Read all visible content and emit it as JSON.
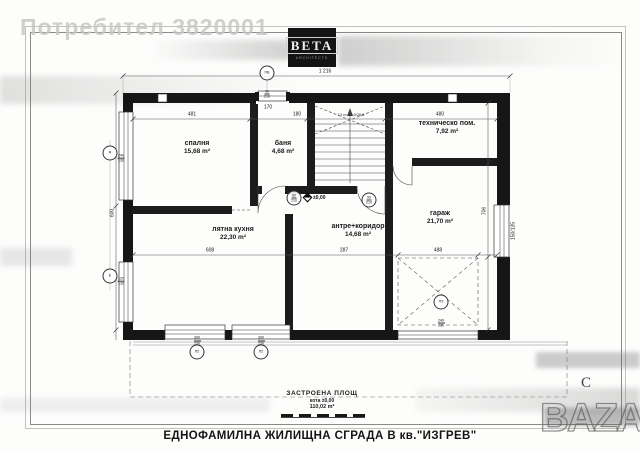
{
  "watermarks": {
    "user": "Потребител 3820001",
    "bazar": "BAZAR"
  },
  "logo": {
    "name": "BETA",
    "sub": "ARCHITECTS"
  },
  "north": "С",
  "plan": {
    "rooms": [
      {
        "name": "спалня",
        "area": "15,68 m²",
        "x": 197,
        "y": 148
      },
      {
        "name": "баня",
        "area": "4,68 m²",
        "x": 283,
        "y": 148
      },
      {
        "name": "техническо пом.",
        "area": "7,92 m²",
        "x": 447,
        "y": 128
      },
      {
        "name": "лятна кухня",
        "area": "22,30 m²",
        "x": 233,
        "y": 234
      },
      {
        "name": "антре+коридор",
        "area": "14,68 m²",
        "x": 358,
        "y": 231
      },
      {
        "name": "гараж",
        "area": "21,70 m²",
        "x": 440,
        "y": 218
      }
    ],
    "level_mark": "±0,00",
    "stair_note": "13 ст. 18,5/28,5",
    "dimensions": [
      {
        "text": "1 216",
        "x": 325,
        "y": 72,
        "rot": 0
      },
      {
        "text": "481",
        "x": 192,
        "y": 115,
        "rot": 0
      },
      {
        "text": "12",
        "x": 253,
        "y": 115,
        "rot": 0
      },
      {
        "text": "180",
        "x": 297,
        "y": 115,
        "rot": 0
      },
      {
        "text": "480",
        "x": 440,
        "y": 115,
        "rot": 0
      },
      {
        "text": "170",
        "x": 268,
        "y": 108,
        "rot": 0
      },
      {
        "text": "608",
        "x": 210,
        "y": 251,
        "rot": 0
      },
      {
        "text": "287",
        "x": 344,
        "y": 251,
        "rot": 0
      },
      {
        "text": "488",
        "x": 438,
        "y": 251,
        "rot": 0
      },
      {
        "text": "600",
        "x": 113,
        "y": 213,
        "rot": -90
      },
      {
        "text": "706",
        "x": 485,
        "y": 211,
        "rot": -90
      },
      {
        "text": "150/135",
        "x": 514,
        "y": 231,
        "rot": -90
      }
    ],
    "markers": [
      {
        "x": 267,
        "y": 73,
        "label": "ПВ",
        "sub": "90/210",
        "subpos": "below"
      },
      {
        "x": 294,
        "y": 198,
        "label": "80/210"
      },
      {
        "x": 369,
        "y": 200,
        "label": "90/210"
      },
      {
        "x": 441,
        "y": 302,
        "label": "ПЗ",
        "sub": "240/230",
        "subpos": "below"
      },
      {
        "x": 197,
        "y": 352,
        "label": "П2",
        "sub": "300/230",
        "subpos": "above"
      },
      {
        "x": 261,
        "y": 352,
        "label": "П2",
        "sub": "300/230",
        "subpos": "above"
      },
      {
        "x": 110,
        "y": 153,
        "label": "Ф",
        "sub": "240/130",
        "subpos": "right"
      },
      {
        "x": 110,
        "y": 276,
        "label": "Е",
        "sub": "120/130",
        "subpos": "right"
      }
    ]
  },
  "title_block": {
    "area_label": "ЗАСТРОЕНА ПЛОЩ",
    "level": "кота ±0,00",
    "area_value": "110,02 m²"
  },
  "sheet_title": "ЕДНОФАМИЛНА ЖИЛИЩНА СГРАДА В кв.\"ИЗГРЕВ\""
}
